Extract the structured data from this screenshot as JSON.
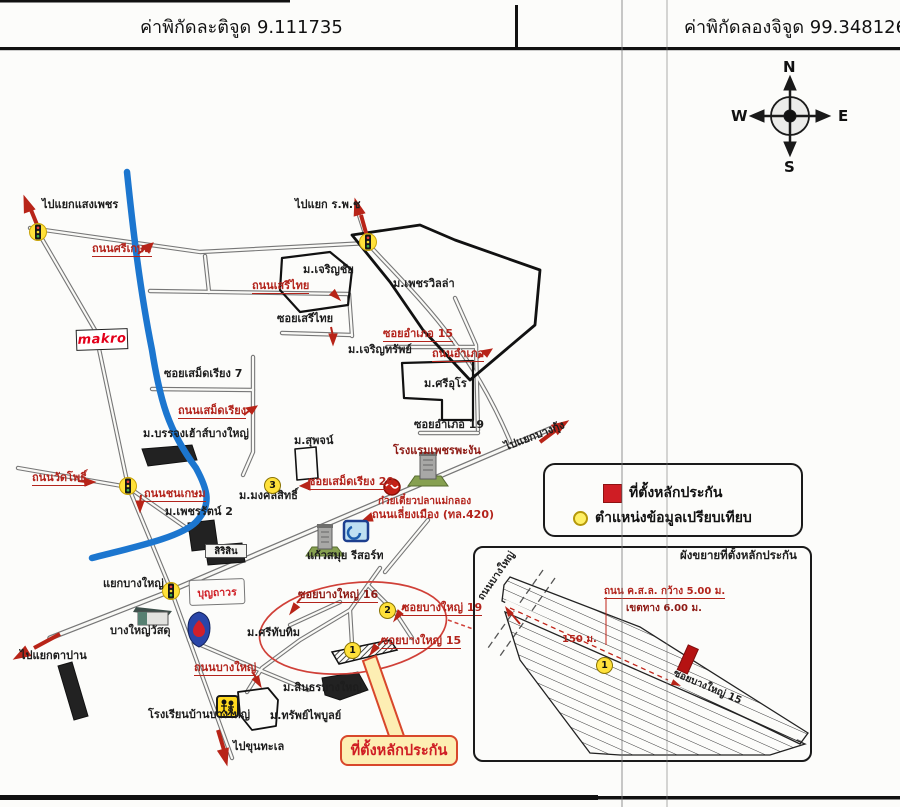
{
  "header": {
    "latitude": "ค่าพิกัดละติจูด 9.111735",
    "longitude": "ค่าพิกัดลองจิจูด 99.348126"
  },
  "compass": {
    "north": "N",
    "south": "S",
    "east": "E",
    "west": "W"
  },
  "legend": {
    "collateral": "ที่ตั้งหลักประกัน",
    "reference": "ตำแหน่งข้อมูลเปรียบเทียบ"
  },
  "callout": {
    "text": "ที่ตั้งหลักประกัน"
  },
  "markers": {
    "m1": "1",
    "m2": "2",
    "m3": "3",
    "inset1": "1"
  },
  "inset": {
    "title": "ผังขยายที่ตั้งหลักประกัน",
    "road_left": "ถนนบางใหญ่",
    "spec_width": "ถนน ค.ส.ล. กว้าง 5.00 ม.",
    "spec_row": "เขตทาง 6.00 ม.",
    "distance": "150 ม.",
    "soi": "ซอยบางใหญ่ 15"
  },
  "map": {
    "labels": {
      "to_saengphet": "ไปแยกแสงเพชร",
      "srikasem": "ถนนศรีเกษม",
      "to_rpc": "ไปแยก ร.พ.ช",
      "charoenchai": "ม.เจริญชัย",
      "serithai_rd": "ถนนเสรีไทย",
      "phetvilla": "ม.เพชรวิลล่า",
      "serithai_soi": "ซอยเสรีไทย",
      "amphoe15": "ซอยอำเภอ 15",
      "charoensap": "ม.เจริญทรัพย์",
      "amphoe_rd": "ถนนอำเภอ",
      "sriuro": "ม.ศรีอุโร",
      "samret7": "ซอยเสม็ดเรียง 7",
      "samret_rd": "ถนนเสม็ดเรียง",
      "banjong": "ม.บรรจงเฮ้าส์บางใหญ่",
      "amphoe19": "ซอยอำเภอ 19",
      "suphot": "ม.สุพจน์",
      "phetphangan": "โรงแรมเพชรพะงัน",
      "to_bangkung": "ไปแยกบางกุ้ง",
      "watpho": "ถนนวัดโพธิ์",
      "chonkasem": "ถนนชนเกษม",
      "mongkolsit": "ม.มงคลสิทธิ์",
      "phetcharat2": "ม.เพชรรัตน์ 2",
      "samret20": "ซอยเสม็ดเรียง 20",
      "noodle": "ก๋วยเตี๋ยวปลาแม่กลอง",
      "liangmueang": "ถนนเลี่ยงเมือง (ทล.420)",
      "kaewsamui": "แก้วสมุย รีสอร์ท",
      "sirisin": "สิริสิน",
      "yaek_bangyai": "แยกบางใหญ่",
      "boonthavorn": "บุญถาวร",
      "bangyai_wasadu": "บางใหญ่วัสดุ",
      "srithapthim": "ม.ศรีทับทิม",
      "to_tapan": "ไปแยกตาปาน",
      "bangyai_rd": "ถนนบางใหญ่",
      "soi16": "ซอยบางใหญ่ 16",
      "soi19": "ซอยบางใหญ่ 19",
      "soi15": "ซอยบางใหญ่ 15",
      "sinthorn": "ม.สินธรบางใหญ่",
      "sapphaiboon": "ม.ทรัพย์ไพบูลย์",
      "school": "โรงเรียนบ้านบางใหญ่",
      "to_khuntalae": "ไปขุนทะเล",
      "makro": "makro"
    }
  },
  "colors": {
    "road_gray": "#777777",
    "river_blue": "#1c76cf",
    "arrow_red": "#b82418",
    "marker_yellow": "#ffe13a",
    "legend_red": "#cf1d24",
    "callout_bg": "#fdeeb3",
    "callout_border": "#d8472b"
  }
}
